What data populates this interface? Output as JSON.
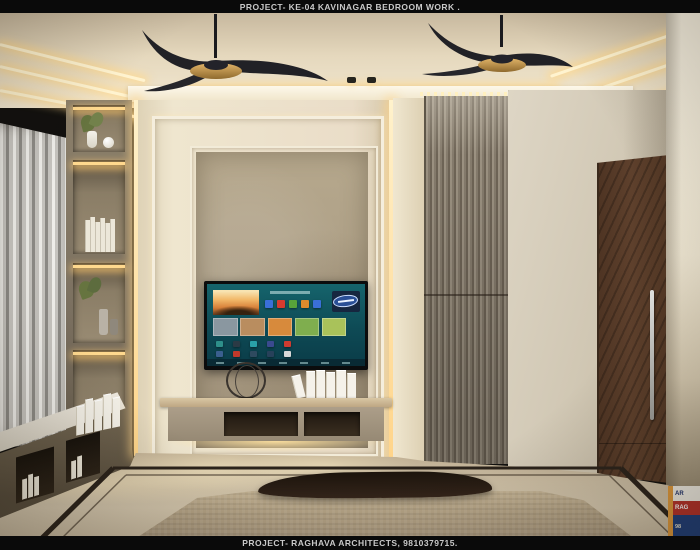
{
  "header": {
    "text": "PROJECT- KE-04 KAVINAGAR BEDROOM WORK ."
  },
  "footer": {
    "text": "PROJECT- RAGHAVA ARCHITECTS, 9810379715."
  },
  "badge": {
    "line1": "AR",
    "line2": "RAG",
    "line3": "98"
  },
  "scene": {
    "colors": {
      "bar_bg": "#0a0a0a",
      "bar_text": "#c9c9c9",
      "ceiling": "#e5d8bd",
      "led_warm": "#ffd98e",
      "fan_blade": "#212126",
      "fan_hub_gold": "#c79c54",
      "curtain": "#c8c6c1",
      "shelf_wall": "#8d816b",
      "molding_cream": "#f5eedd",
      "panel_inner": "#b0a287",
      "tv_screen_teal": "#11565e",
      "console_body": "#a79a86",
      "fluted_panel": "#8c8273",
      "marble_wall": "#d6cdbb",
      "door_wood": "#553927",
      "right_wall": "#efe7d3",
      "floor": "#ccbea4",
      "floor_inlay": "#2b231b",
      "rug": "#b2a184",
      "bench": "#241a10"
    }
  },
  "tv": {
    "ui": "smart-tv-home-screen",
    "top_icon_colors": [
      "#3a6fd8",
      "#d63b2f",
      "#57a33a",
      "#e08b2d",
      "#3a6fd8"
    ],
    "mid_card_colors": [
      "#8a97a0",
      "#b98d5f",
      "#d78a3c",
      "#7fae4e",
      "#a9c25a"
    ],
    "app_row1_colors": [
      "#2e8f8a",
      "#2b3a45",
      "#2aa0a8",
      "#3a4a8f",
      "#cf3b30"
    ],
    "app_row2_colors": [
      "#3a5f8f",
      "#c0392b",
      "#2e4a5f",
      "#27415a",
      "#d8d8d8"
    ]
  }
}
